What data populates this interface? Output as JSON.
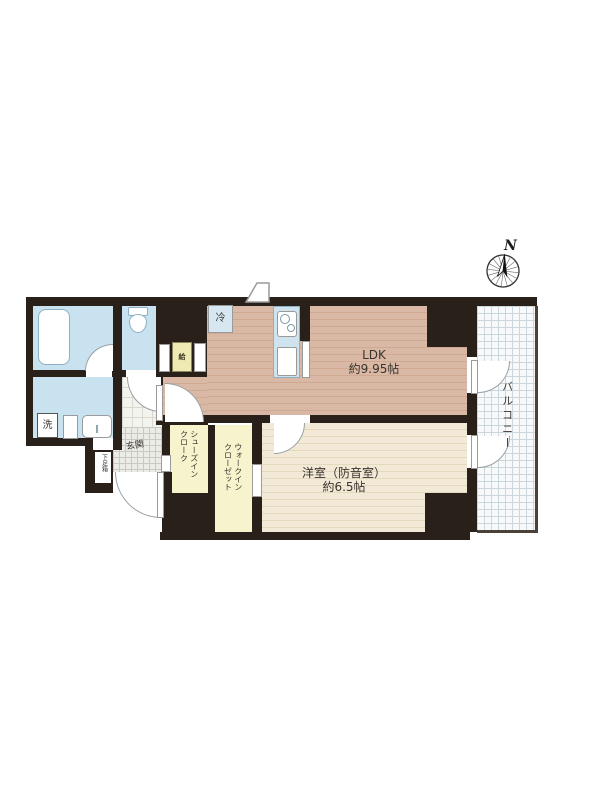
{
  "floorplan": {
    "compass_label": "N",
    "ldk": {
      "name": "LDK",
      "area": "約9.95帖"
    },
    "western_room": {
      "name": "洋室（防音室）",
      "area": "約6.5帖"
    },
    "balcony_label": "バルコニー",
    "entrance_label": "玄関",
    "shoe_box_label": "下足箱",
    "shoes_in_cloak": {
      "line1": "シューズイン",
      "line2": "クローク"
    },
    "walk_in_closet": {
      "line1": "ウォークイン",
      "line2": "クローゼット"
    },
    "laundry_label": "洗",
    "refrigerator_label": "冷",
    "water_heater_label": "給",
    "colors": {
      "wall": "#282019",
      "ldk_floor": "#d9b9a5",
      "western_floor": "#f2e9d6",
      "wet_area": "#c9e2f0",
      "closet": "#f6f3cd",
      "balcony_grid": "#ccd6dd",
      "tile": "#ecece6"
    }
  }
}
